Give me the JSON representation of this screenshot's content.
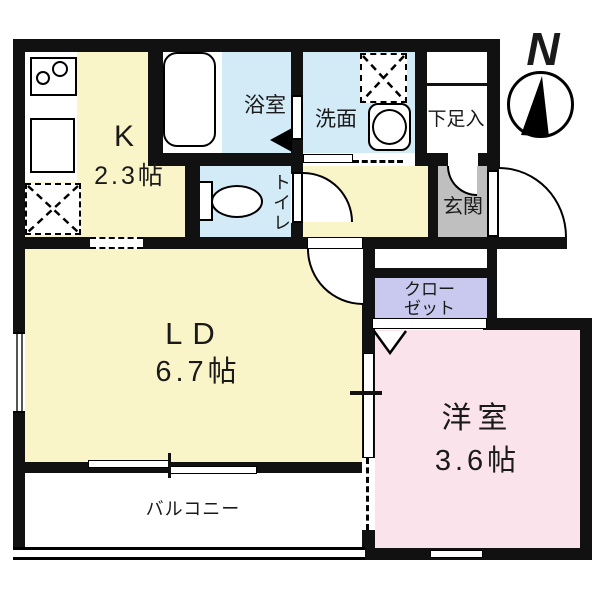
{
  "compass": {
    "north_label": "N"
  },
  "rooms": {
    "kitchen": {
      "label": "K",
      "area": "2.3帖"
    },
    "bath": {
      "label": "浴室"
    },
    "washroom": {
      "label": "洗面"
    },
    "toilet": {
      "label": "トイレ"
    },
    "shoe_cabinet": {
      "label": "下足入"
    },
    "entrance": {
      "label": "玄関"
    },
    "closet": {
      "label": "クロー\nゼット"
    },
    "living_dining": {
      "label": "LD",
      "area": "6.7帖"
    },
    "western_room": {
      "label": "洋室",
      "area": "3.6帖"
    },
    "balcony": {
      "label": "バルコニー"
    }
  },
  "colors": {
    "room_yellow": "#FAF5C8",
    "wet_blue": "#D3EAF7",
    "bedroom_pink": "#FAE3EB",
    "closet_purple": "#C9C9EF",
    "entrance_gray": "#BFBFBF",
    "wall_black": "#111111"
  }
}
